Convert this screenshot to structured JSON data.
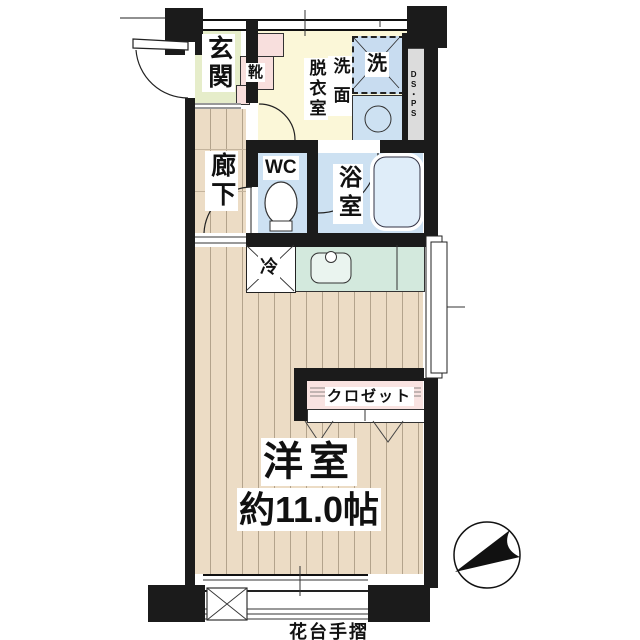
{
  "floor_plan": {
    "rooms": {
      "entrance": {
        "label": "玄関"
      },
      "shoe_cabinet": {
        "label": "靴"
      },
      "washroom": {
        "label_col_right": "洗面",
        "label_col_left": "脱衣室"
      },
      "washing_machine": {
        "label": "洗"
      },
      "pipe_space": {
        "label": "DS・PS"
      },
      "corridor": {
        "label": "廊下"
      },
      "toilet": {
        "label": "WC"
      },
      "bathroom": {
        "label": "浴室"
      },
      "refrigerator": {
        "label": "冷"
      },
      "closet": {
        "label": "クロゼット"
      },
      "western_room": {
        "label": "洋室",
        "size": "約11.0帖"
      },
      "balcony": {
        "label": "花台手摺"
      }
    },
    "colors": {
      "wall": "#1b1b1b",
      "label_bg": "#ffffff",
      "entrance_green": "#e6edca",
      "pink": "#f8dfdd",
      "washroom_cream": "#fbf7d8",
      "water_blue": "#cde1f2",
      "washer_blue": "#c8dcf0",
      "pipe_gray": "#dcdcdc",
      "wood": "#ecdcc5",
      "kitchen_mint": "#d3e9dd",
      "closet_pink": "#f9e3e1",
      "bathtub_blue": "#dfedf9"
    }
  }
}
